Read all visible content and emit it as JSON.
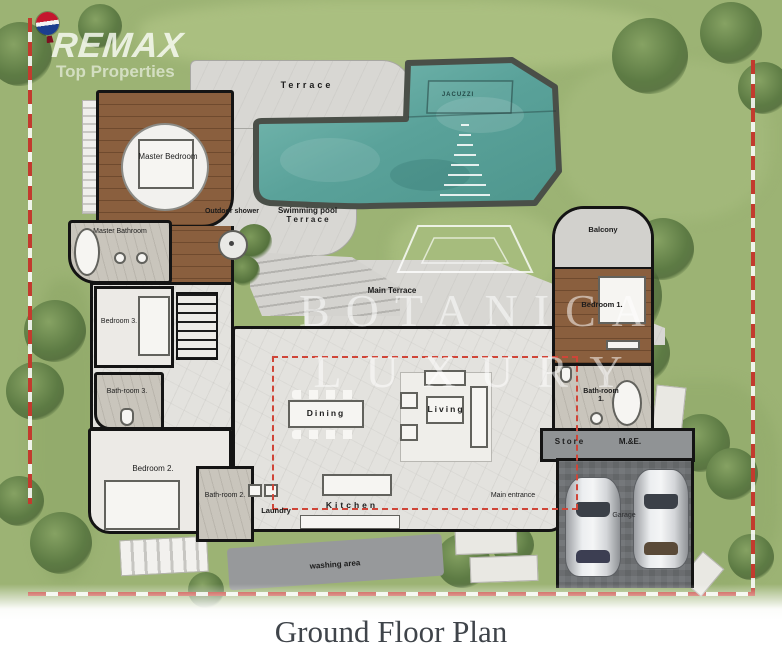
{
  "logo": {
    "brand": "REMAX",
    "tagline": "Top Properties"
  },
  "watermark": {
    "line1": "BOTANICA",
    "line2": "LUXURY"
  },
  "title": "Ground Floor Plan",
  "rooms": {
    "terrace": "Terrace",
    "jacuzzi": "JACUZZI",
    "pool_terrace1": "Swimming pool",
    "pool_terrace2": "T e r r a c e",
    "outdoor_shower": "Outdoor shower",
    "master_bedroom": "Master Bedroom",
    "master_bathroom": "Master Bathroom",
    "bedroom3": "Bedroom 3.",
    "bathroom3": "Bath-room 3.",
    "bedroom2": "Bedroom 2.",
    "bathroom2": "Bath-room 2.",
    "laundry": "Laundry",
    "kitchen": "Kitchen",
    "washing_area": "washing area",
    "main_terrace": "Main Terrace",
    "dining": "Dining",
    "living": "Living",
    "balcony": "Balcony",
    "bedroom1": "Bedroom 1.",
    "bathroom1": "Bath-room 1.",
    "store": "Store",
    "me": "M.&E.",
    "garage": "Garage",
    "main_entrance": "Main entrance"
  },
  "colors": {
    "lawn": "#9cb374",
    "water": "#5fa69e",
    "wood": "#8a5f3e",
    "marble": "#e3e2de",
    "stone": "#c9c5bc",
    "garage_dark": "#6e7174",
    "wall": "#141414",
    "boundary_red": "#c23b2e",
    "balloon_red": "#c4172e",
    "balloon_blue": "#1b3e8f"
  }
}
